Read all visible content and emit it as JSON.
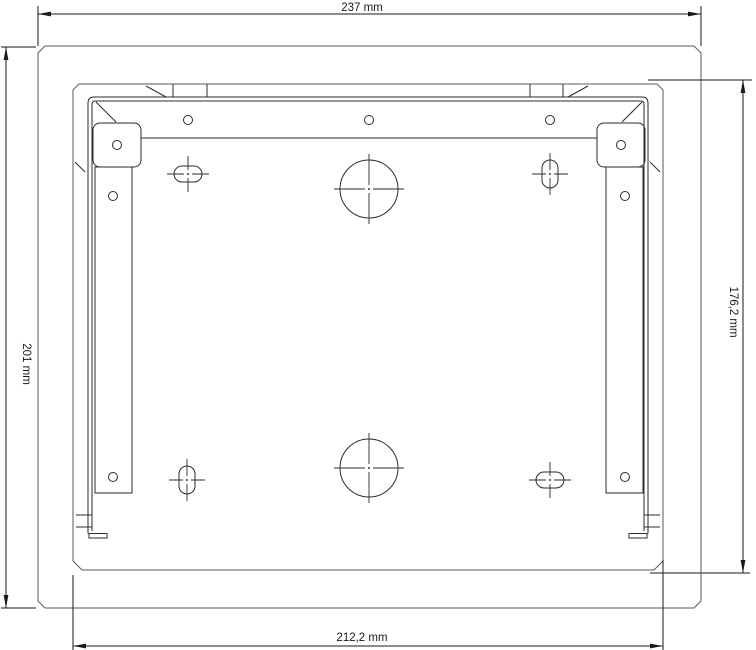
{
  "drawing": {
    "type": "technical-drawing",
    "units": "mm",
    "dimensions": {
      "overall_width": {
        "label": "237 mm",
        "value": 237,
        "position": "top"
      },
      "overall_height": {
        "label": "201 mm",
        "value": 201,
        "position": "left"
      },
      "inner_height": {
        "label": "176,2 mm",
        "value": 176.2,
        "position": "right"
      },
      "inner_width": {
        "label": "212,2 mm",
        "value": 212.2,
        "position": "bottom"
      }
    },
    "features": {
      "large_circular_holes": {
        "count": 2,
        "location": "vertical-centerline"
      },
      "slotted_holes": {
        "count": 4,
        "orientations": [
          "horizontal-top-left",
          "vertical-top-right",
          "vertical-bottom-left",
          "horizontal-bottom-right"
        ]
      },
      "small_round_holes": {
        "count": 9
      },
      "top_hanger_tabs": {
        "count": 2
      },
      "corner_gussets": {
        "count": 2
      },
      "side_rails": {
        "count": 2
      }
    },
    "colors": {
      "background": "#ffffff",
      "enclosure_line": "#5a5a5a",
      "plate_line": "#2b2b2b",
      "dimension_line": "#1a1a1a"
    }
  }
}
